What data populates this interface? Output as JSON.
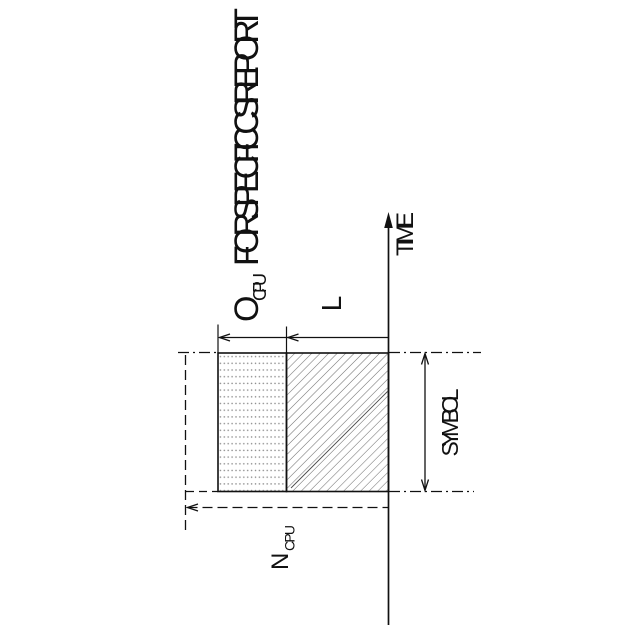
{
  "figure": {
    "background": "#ffffff",
    "line_color": "#111111",
    "hatch_color": "#757575",
    "accent_hatch_color": "#4a4a4a",
    "dot_color": "#8a8a8a",
    "title": {
      "symbol": "O",
      "subscript": "CPU",
      "text": "FOR SPECIFIC CSI REPORT"
    },
    "time_axis": {
      "label": "TIME"
    },
    "labels": {
      "l": "L",
      "symbol": "SYMBOL",
      "n_symbol": "N",
      "n_subscript": "CPU"
    }
  }
}
